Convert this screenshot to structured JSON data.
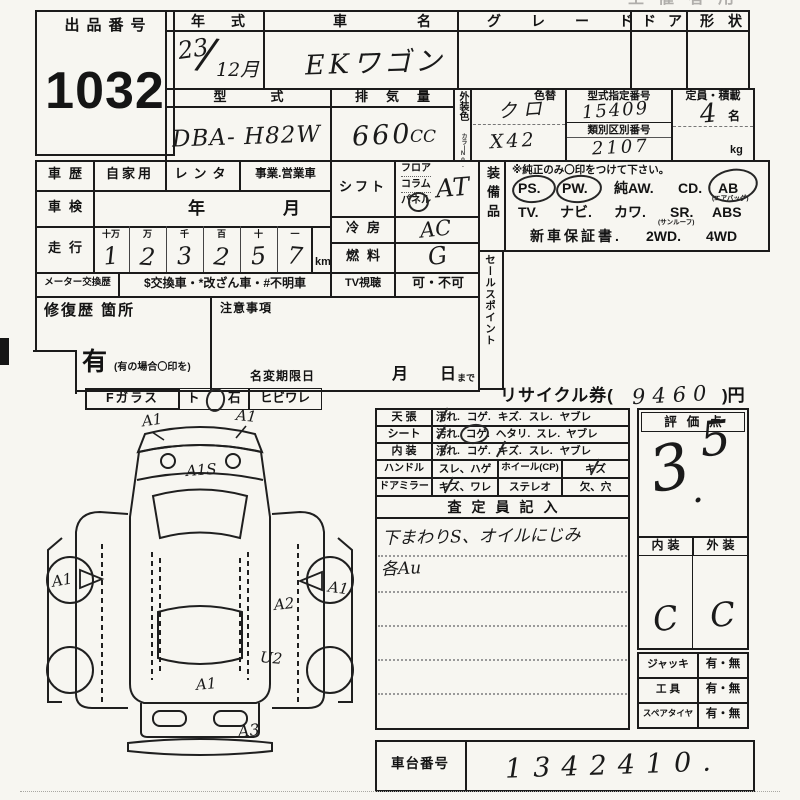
{
  "meta": {
    "faint_title": "主催者用"
  },
  "lot": {
    "label": "出品番号",
    "number": "1032"
  },
  "vehicle": {
    "year_label": "年式",
    "year_era": "23",
    "year_slash": "/",
    "year_month": "12月",
    "name_label": "車名",
    "name_value": "EKワゴン",
    "grade_label": "グレード",
    "door_label": "ドア",
    "shape_label": "形状",
    "model_label": "型式",
    "model_value": "DBA- H82W",
    "disp_label": "排気量",
    "disp_value": "660",
    "disp_unit": "CC",
    "color_label": "外装色",
    "color_no_label": "カラーNo.",
    "recolor_label": "色替",
    "color_value": "クロ",
    "color_code": "X42",
    "type_no_label": "型式指定番号",
    "type_no_value": "15409",
    "class_no_label": "類別区別番号",
    "class_no_value": "2107",
    "capacity_label": "定員・積載",
    "capacity_value": "4",
    "capacity_unit": "名",
    "payload_unit": "kg"
  },
  "history": {
    "label": "車歴",
    "private": "自家用",
    "rental": "レンタ",
    "commercial": "事業.営業車",
    "inspection_label": "車検",
    "inspection_year": "年",
    "inspection_month": "月",
    "mileage_label": "走行",
    "mileage_cols": [
      "十万",
      "万",
      "千",
      "百",
      "十",
      "一"
    ],
    "mileage_digits": [
      "1",
      "2",
      "3",
      "2",
      "5",
      "7"
    ],
    "mileage_unit": "km",
    "meter_label": "メーター交換歴",
    "meter_options": "$交換車・*改ざん車・#不明車"
  },
  "controls": {
    "shift_label": "シフト",
    "shift_floor": "フロア",
    "shift_column": "コラム",
    "shift_panel": "パネル",
    "shift_value": "AT",
    "ac_label": "冷房",
    "ac_value": "AC",
    "fuel_label": "燃料",
    "fuel_value": "G",
    "tv_label": "TV視聴",
    "tv_options": "可・不可"
  },
  "equipment": {
    "label": "装備品",
    "note": "※純正のみ〇印をつけて下さい。",
    "row1": [
      "PS.",
      "PW.",
      "純AW.",
      "CD.",
      "AB"
    ],
    "row1_note": "(エアバッグ)",
    "row2": [
      "TV.",
      "ナビ.",
      "カワ.",
      "SR.",
      "ABS"
    ],
    "row2_note": "(サンルーフ)",
    "row3": [
      "新車保証書.",
      "2WD.",
      "4WD"
    ]
  },
  "sales_label": "セールスポイント",
  "repair": {
    "label": "修復歴 箇所",
    "has": "有",
    "has_note": "(有の場合〇印を)"
  },
  "notice": {
    "label": "注意事項",
    "rename_label": "名変期限日",
    "month": "月",
    "day": "日",
    "made": "まで"
  },
  "recycle": {
    "label": "リサイクル券(",
    "value": "9460",
    "suffix": ")円"
  },
  "glass": {
    "label": "Fガラス",
    "opt1": "ト",
    "opt2": "石",
    "opt3": "ヒビワレ"
  },
  "condition": {
    "rows": [
      {
        "label": "天 張",
        "items": [
          "汚れ.",
          "コゲ.",
          "キズ.",
          "スレ.",
          "ヤブレ"
        ]
      },
      {
        "label": "シート",
        "items": [
          "汚れ.",
          "コゲ.",
          "ヘタリ.",
          "スレ.",
          "ヤブレ"
        ]
      },
      {
        "label": "内 装",
        "items": [
          "汚れ.",
          "コゲ.",
          "キズ.",
          "スレ.",
          "ヤブレ"
        ]
      }
    ],
    "handle_label": "ハンドル",
    "handle_items": "スレ、ハゲ",
    "wheel_label": "ホイール(CP)",
    "wheel_items": "キズ",
    "mirror_label": "ドアミラー",
    "mirror_items": "キズ、ワレ",
    "stereo_label": "ステレオ",
    "stereo_items": "欠、穴",
    "inspector_label": "査定員記入",
    "note1": "下まわりS、オイルにじみ",
    "note2": "各Au"
  },
  "score": {
    "label": "評価点",
    "int": "3",
    "dot": ".",
    "dec": "5",
    "interior_label": "内装",
    "exterior_label": "外装",
    "interior_value": "C",
    "exterior_value": "C"
  },
  "accessories": {
    "jack_label": "ジャッキ",
    "jack_value": "有・無",
    "tool_label": "工 具",
    "tool_value": "有・無",
    "spare_label": "スペアタイヤ",
    "spare_value": "有・無"
  },
  "chassis": {
    "label": "車台番号",
    "value": "1342410."
  },
  "diagram": {
    "marks": [
      "A1",
      "A1",
      "A1S",
      "A1",
      "A1",
      "A2",
      "U2",
      "A1",
      "A3"
    ]
  }
}
